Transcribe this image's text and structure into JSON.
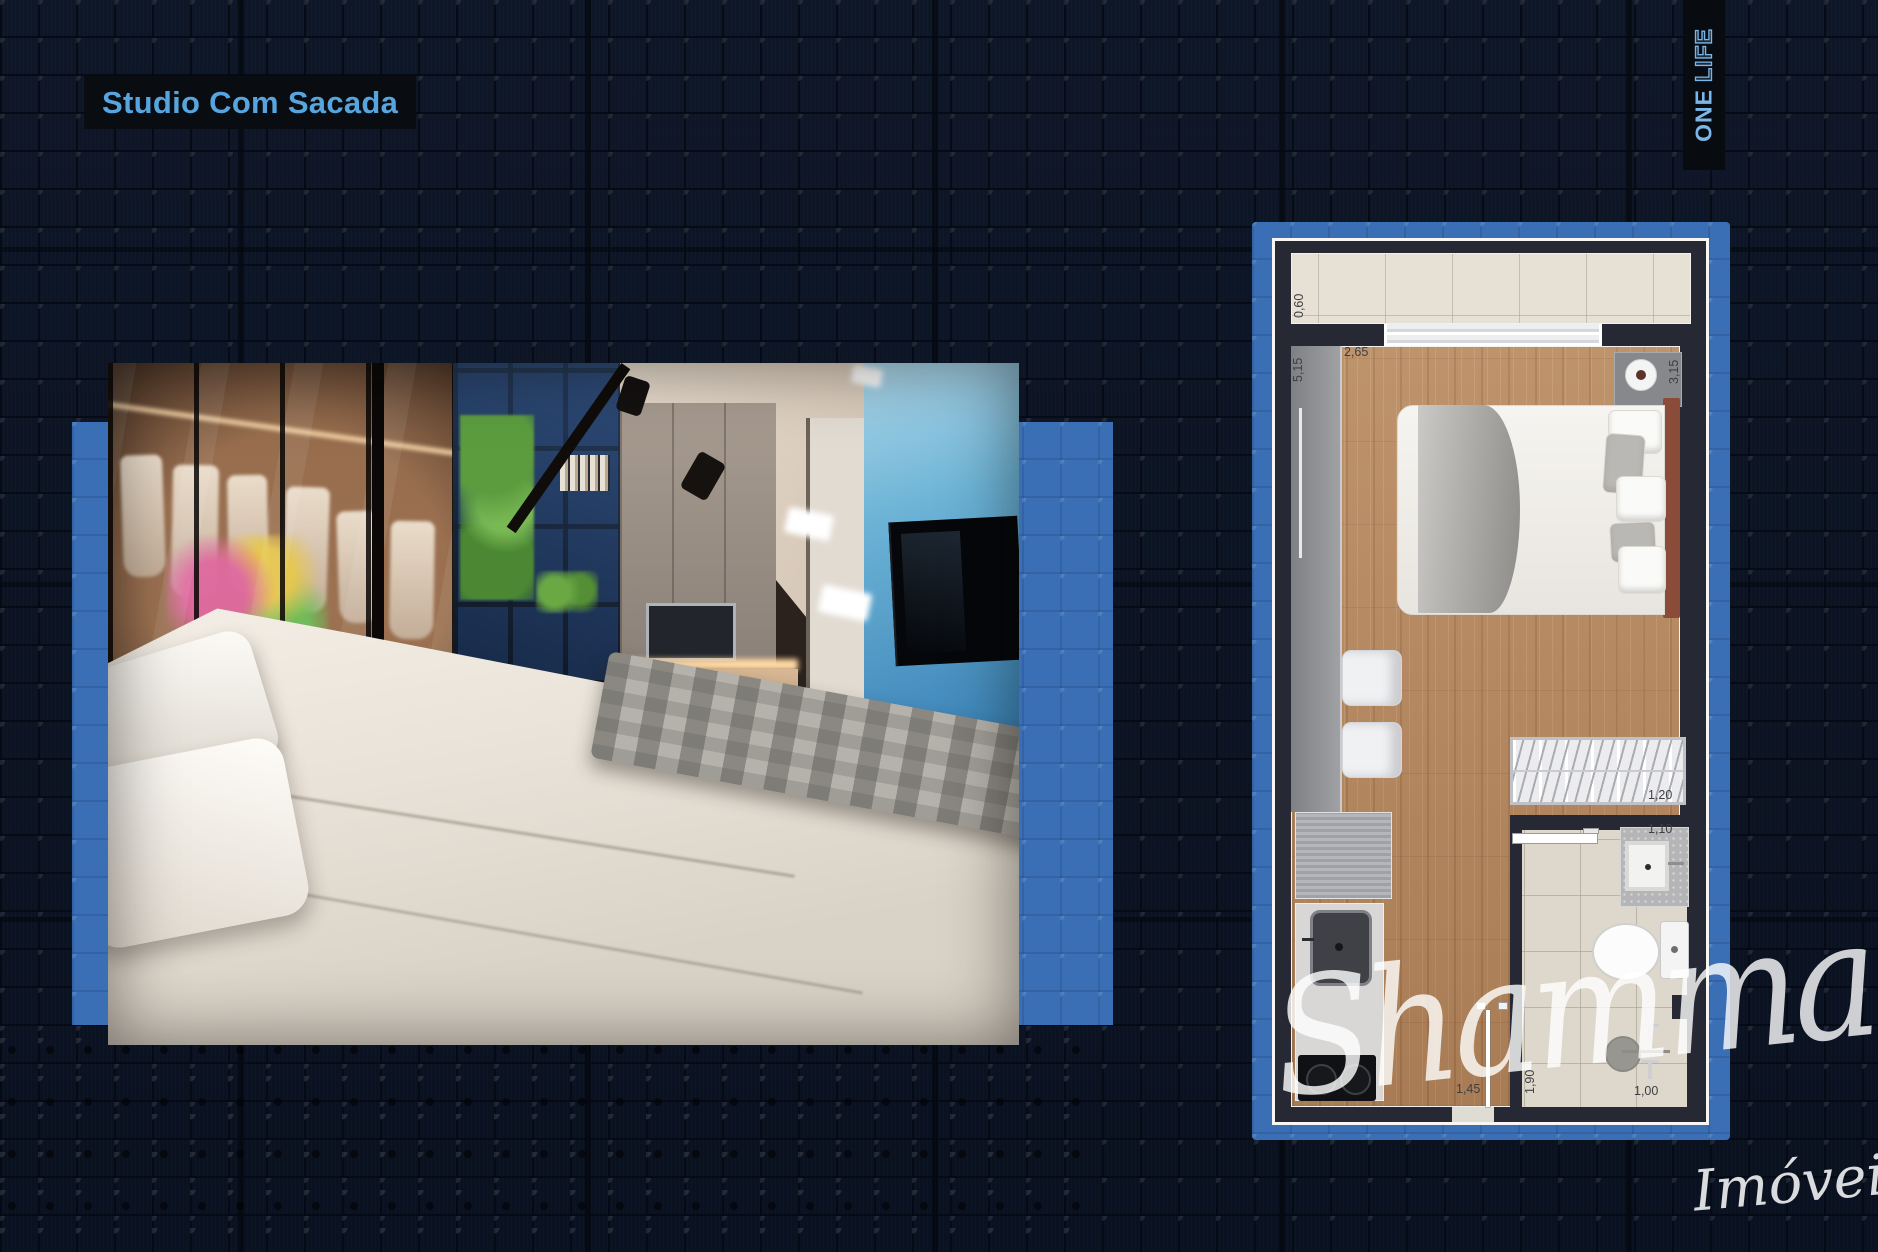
{
  "header": {
    "title": "Studio Com Sacada"
  },
  "brand": {
    "word1": "ONE",
    "word2": "LIFE"
  },
  "watermark": {
    "name": "Shammah",
    "subtitle": "Imóveis"
  },
  "plan": {
    "measurements": {
      "balcony_depth": "0,60",
      "bedroom_width": "2,65",
      "left_length": "5,15",
      "right_length": "3,15",
      "closet_width": "1,20",
      "bathroom_width": "1,10",
      "kitchen_width": "1,45",
      "bathroom_length": "1,90",
      "shower_width": "1,00"
    }
  },
  "colors": {
    "accent_blue": "#3b6fb5",
    "title_blue": "#57a5de",
    "background_navy": "#0c1424",
    "wall_dark": "#262833",
    "wood_floor": "#b5875d"
  }
}
